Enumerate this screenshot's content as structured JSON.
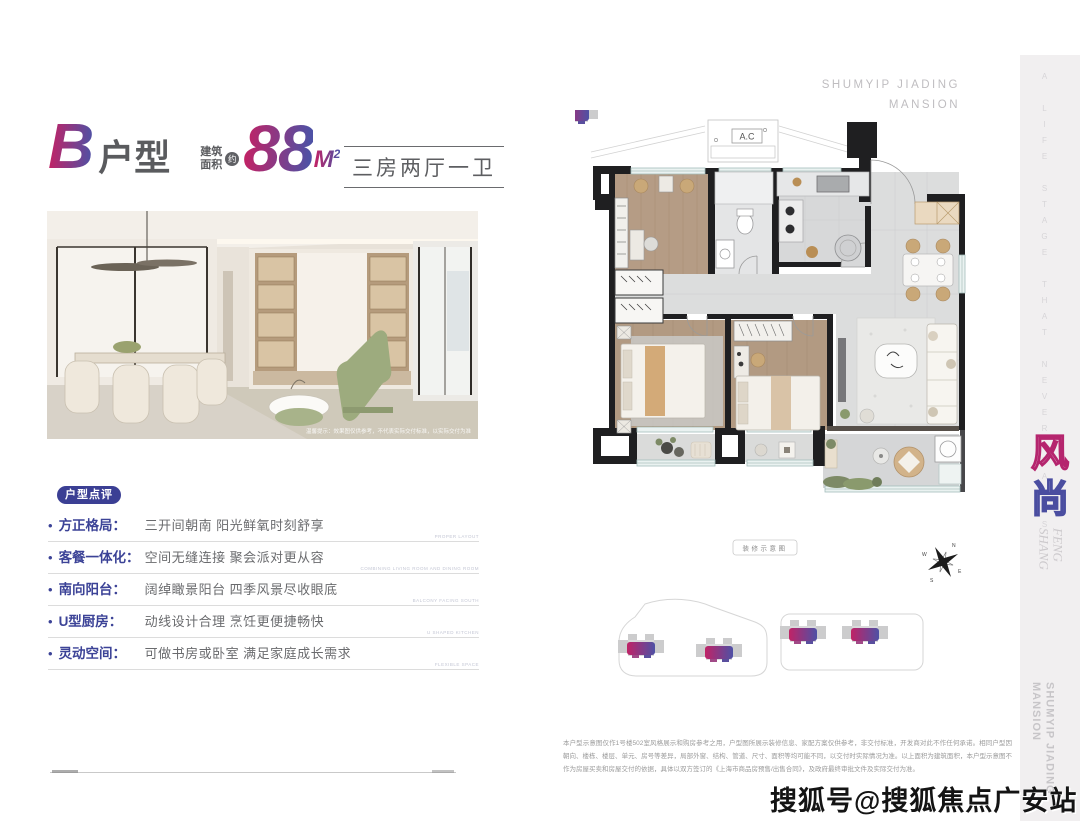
{
  "header": {
    "unit_letter": "B",
    "unit_label": "户型",
    "area_prefix": "建筑\n面积",
    "area_approx": "约",
    "area_value": "88",
    "area_unit": "M",
    "area_sup": "2",
    "layout_summary": "三房两厅一卫",
    "brand_top": "SHUMYIP JIADING\nMANSION"
  },
  "photo": {
    "caption": "温馨提示：效果图仅供参考，不代表实际交付标准，以实际交付为准"
  },
  "review": {
    "badge": "户型点评",
    "items": [
      {
        "term": "方正格局：",
        "desc": "三开间朝南 阳光鲜氧时刻舒享",
        "en": "PROPER LAYOUT"
      },
      {
        "term": "客餐一体化：",
        "desc": "空间无缝连接 聚会派对更从容",
        "en": "COMBINING LIVING ROOM AND DINING ROOM"
      },
      {
        "term": "南向阳台：",
        "desc": "阔绰瞰景阳台 四季风景尽收眼底",
        "en": "BALCONY FACING SOUTH"
      },
      {
        "term": "U型厨房：",
        "desc": "动线设计合理 烹饪更便捷畅快",
        "en": "U SHAPED KITCHEN"
      },
      {
        "term": "灵动空间：",
        "desc": "可做书房或卧室 满足家庭成长需求",
        "en": "FLEXIBLE SPACE"
      }
    ]
  },
  "floorplan": {
    "ac_label": "A.C",
    "legend": "装修示意图",
    "compass": {
      "n": "N",
      "e": "E",
      "s": "S",
      "w": "W"
    }
  },
  "sidebar": {
    "tagline": "A LIFE STAGE THAT NEVER FADES",
    "feng": "风",
    "shang": "尚",
    "feng_shang_en": "FENG\nSHANG",
    "brand_vertical": "SHUMYIP JIADING\nMANSION"
  },
  "footer": {
    "disclaimer": "本户型示意图仅作1号楼502室风格展示和购房参考之用，户型图所展示装修信息、家配方案仅供参考，非交付标准，开发商对此不作任何承诺。相同户型因朝向、楼栋、楼层、单元、房号等差异，局部外窗、结构、管道、尺寸、面积等均可能不同，以交付时实际情况为准。以上面积为建筑面积，本户型示意图不作为房屋买卖和房屋交付的依据，具体以双方签订的《上海市商品房预售/出售合同》，及政府最终审批文件及实际交付为准。",
    "watermark": "搜狐号@搜狐焦点广安站"
  },
  "colors": {
    "gradient_start": "#c02366",
    "gradient_end": "#4e51a5",
    "badge_blue": "#3b3f94",
    "term_blue": "#3c4397",
    "sidebar_bg": "#f1eff0"
  }
}
